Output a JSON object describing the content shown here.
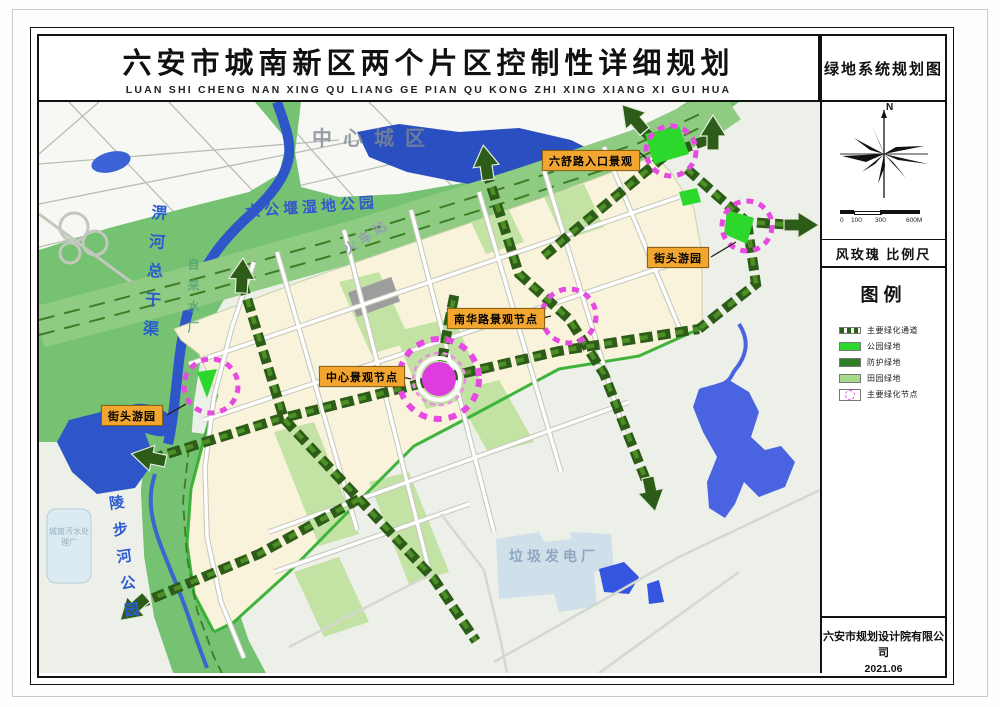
{
  "title": {
    "cn": "六安市城南新区两个片区控制性详细规划",
    "pinyin": "LUAN SHI CHENG NAN XING QU LIANG GE PIAN QU KONG ZHI XING XIANG XI GUI HUA"
  },
  "side_panel": {
    "map_name": "绿地系统规划图",
    "north_label": "N",
    "scale_labels": [
      "0",
      "100",
      "300",
      "600M"
    ],
    "compass_caption": "风玫瑰 比例尺",
    "legend_title": "图例",
    "legend_items": [
      {
        "label": "主要绿化通道",
        "type": "corridor"
      },
      {
        "label": "公园绿地",
        "type": "solid",
        "color": "#2bd82b"
      },
      {
        "label": "防护绿地",
        "type": "solid",
        "color": "#2e7d27"
      },
      {
        "label": "田园绿地",
        "type": "solid",
        "color": "#a6d98c"
      },
      {
        "label": "主要绿化节点",
        "type": "node"
      }
    ],
    "company": "六安市规划设计院有限公司",
    "date": "2021.06"
  },
  "map": {
    "labels": {
      "city_center": "中心城区",
      "wetland_park": "大公堰湿地公园",
      "railway_station": "火车站",
      "waste_plant": "垃圾发电厂",
      "sewage_plant": "城南污水处理厂",
      "canal": "淠河总干渠",
      "water_works": "自来水厂",
      "river_park": "陵步河公园"
    },
    "callouts": [
      {
        "label": "六舒路入口景观"
      },
      {
        "label": "街头游园"
      },
      {
        "label": "南华路景观节点"
      },
      {
        "label": "中心景观节点"
      },
      {
        "label": "街头游园"
      }
    ]
  },
  "colors": {
    "callout_bg": "#f2a52f",
    "node_magenta": "#e74ae0",
    "corridor_green": "#2c5c17",
    "park_bright_green": "#2bd82b",
    "protective_green": "#74c272",
    "block_cream": "#f8f3da",
    "water_blue": "#2e56c8"
  }
}
